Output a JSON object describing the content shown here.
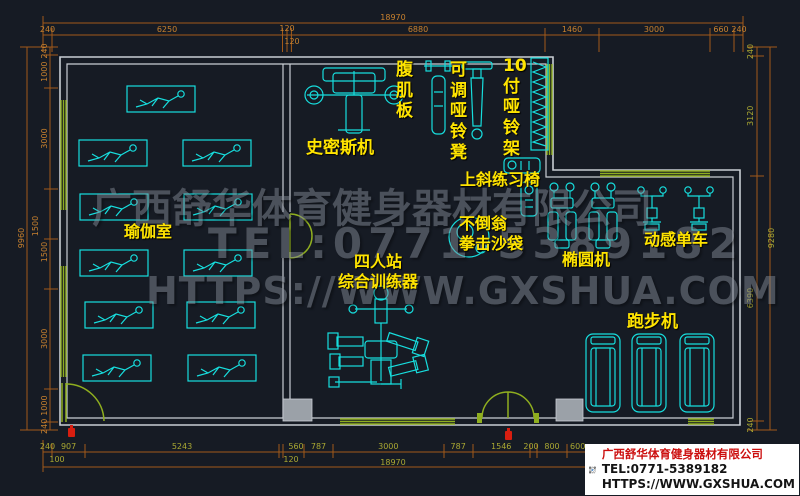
{
  "watermark": {
    "line1": "广西舒华体育健身器材有限公司",
    "line2": "TEL:0771-5389182",
    "line3": "HTTPS://WWW.GXSHUA.COM"
  },
  "logo": {
    "company": "广西舒华体育健身器材有限公司",
    "tel": "TEL:0771-5389182",
    "url": "HTTPS://WWW.GXSHUA.COM"
  },
  "rooms": {
    "yoga": "瑜伽室"
  },
  "equipment_labels": {
    "smith": "史密斯机",
    "ab_board": "腹\n肌\n板",
    "adj_bench": "可\n调\n哑\n铃\n凳",
    "dumbbell_rack": "10\n付\n哑\n铃\n架",
    "incline_chair": "上斜练习椅",
    "tumbler_bag": "不倒翁\n拳击沙袋",
    "multi_station": "四人站\n综合训练器",
    "elliptical": "椭圆机",
    "spin_bike": "动感单车",
    "treadmill": "跑步机"
  },
  "counts": {
    "yoga_mats": 11,
    "ellipticals": 2,
    "spin_bikes": 2,
    "treadmills": 3
  },
  "dims": {
    "top_total": "18970",
    "top": [
      "240",
      "6250",
      "120",
      "120",
      "6880",
      "1460",
      "3000",
      "660",
      "240"
    ],
    "left_total": "9960",
    "left": [
      "240",
      "1000",
      "3000",
      "1500",
      "1500",
      "3000",
      "1000",
      "240"
    ],
    "right_total": "9280",
    "right": [
      "240",
      "3120",
      "6390",
      "240"
    ],
    "bottom": [
      "240",
      "907",
      "5243",
      "560",
      "787",
      "3000",
      "787",
      "1546",
      "200",
      "800",
      "600"
    ],
    "bottom_sub": [
      "100",
      "120"
    ],
    "bottom_total": "18970"
  },
  "colors": {
    "background": "#161b24",
    "equipment": "#17dede",
    "walls": "#c9ced4",
    "windows_doors": "#8fae1f",
    "dimension_lines": "#a25a1a",
    "labels": "#ffe400",
    "logo_company_red": "#cc0f0f"
  }
}
